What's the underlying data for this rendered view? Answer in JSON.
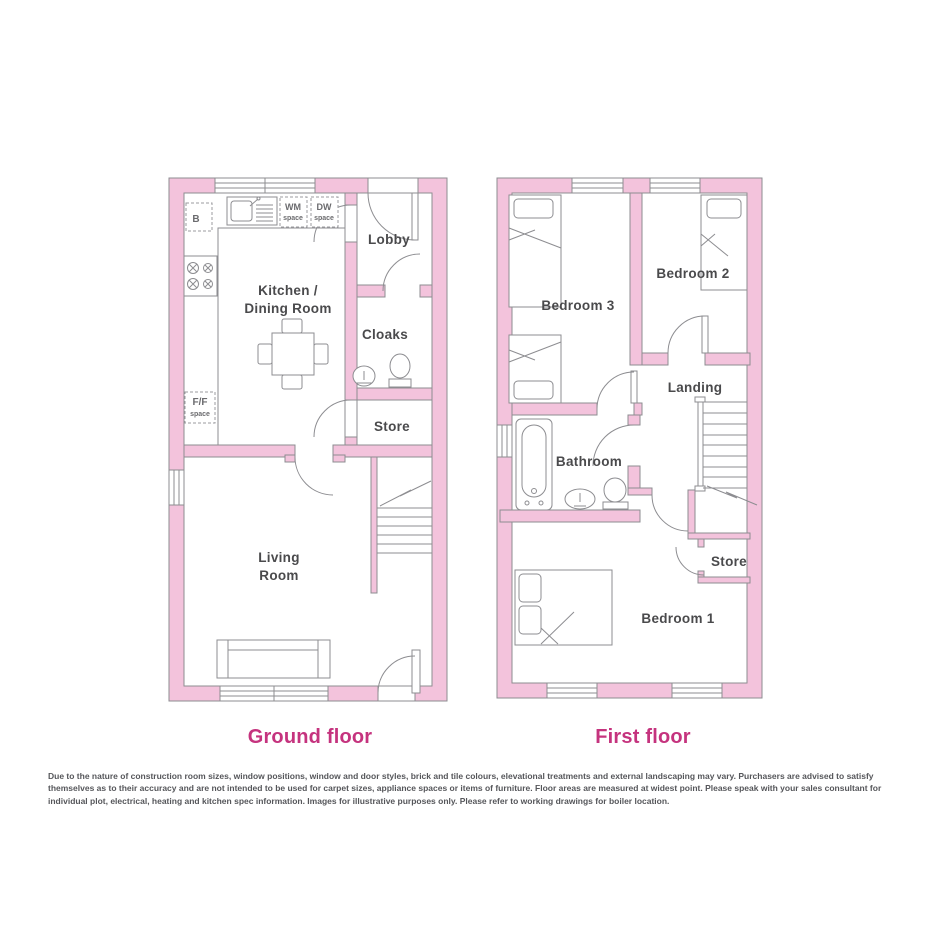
{
  "colors": {
    "wall_pink": "#F3C3DC",
    "outline_gray": "#8D8D91",
    "label_gray": "#4A4A4C",
    "accent_pink": "#C5337E"
  },
  "ground_floor": {
    "caption": "Ground floor",
    "rooms": {
      "kitchen_line1": "Kitchen /",
      "kitchen_line2": "Dining Room",
      "lobby": "Lobby",
      "cloaks": "Cloaks",
      "store": "Store",
      "living_line1": "Living",
      "living_line2": "Room"
    },
    "appliances": {
      "boiler": "B",
      "wm_line1": "WM",
      "wm_line2": "space",
      "dw_line1": "DW",
      "dw_line2": "space",
      "ff_line1": "F/F",
      "ff_line2": "space"
    }
  },
  "first_floor": {
    "caption": "First floor",
    "rooms": {
      "bedroom3": "Bedroom 3",
      "bedroom2": "Bedroom 2",
      "landing": "Landing",
      "bathroom": "Bathroom",
      "store": "Store",
      "bedroom1": "Bedroom 1"
    }
  },
  "disclaimer": "Due to the nature of construction room sizes, window positions, window and door styles, brick and tile colours, elevational treatments and external landscaping may vary. Purchasers are advised to satisfy themselves as to their accuracy and are not intended to be used for carpet sizes, appliance spaces or items of furniture. Floor areas are measured at widest point. Please speak with your sales consultant for individual plot, electrical, heating and kitchen spec information. Images for illustrative purposes only. Please refer to working drawings for boiler location."
}
